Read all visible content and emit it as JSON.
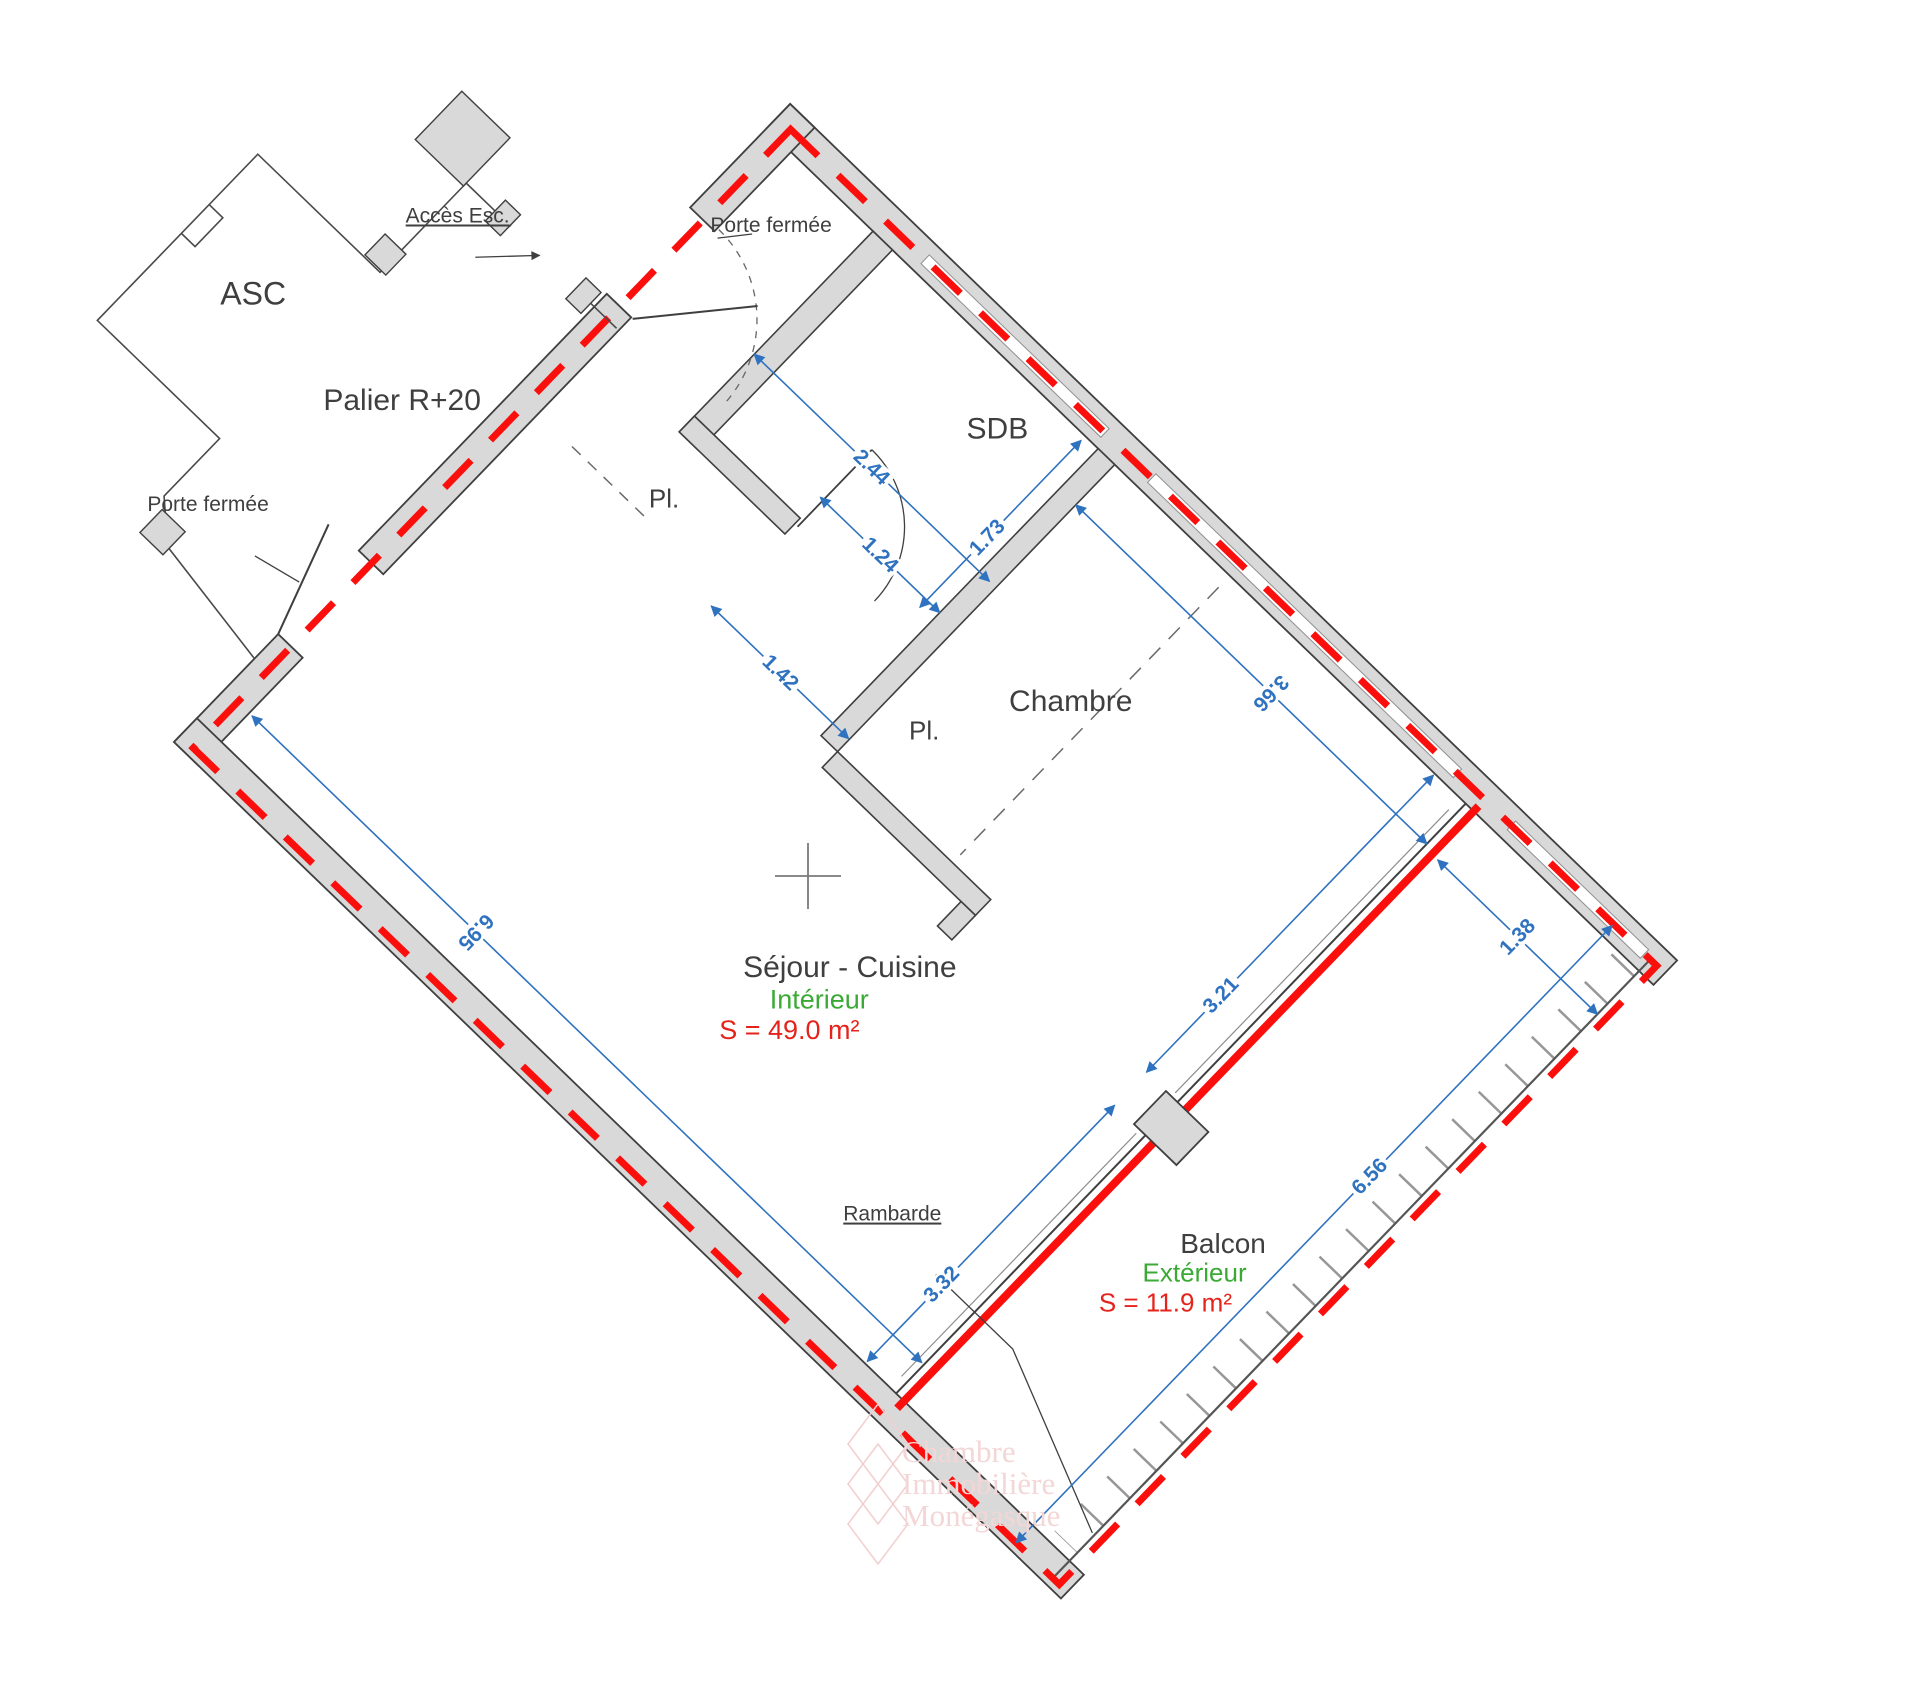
{
  "landing": {
    "asc": "ASC",
    "palier": "Palier R+20",
    "acces_esc": "Accès Esc.",
    "porte_fermee_top": "Porte fermée",
    "porte_fermee_left": "Porte fermée"
  },
  "rooms": {
    "sdb": "SDB",
    "pl_hall": "Pl.",
    "pl_chambre": "Pl.",
    "chambre": "Chambre",
    "sejour": "Séjour - Cuisine",
    "interieur": "Intérieur",
    "surface_interieur": "S = 49.0 m²",
    "balcon": "Balcon",
    "exterieur": "Extérieur",
    "surface_exterieur": "S = 11.9 m²",
    "rambarde": "Rambarde"
  },
  "dimensions": {
    "sdb_width": "2.44",
    "sdb_door": "1.24",
    "hall_width": "1.42",
    "sdb_depth": "1.73",
    "chambre_width": "3.66",
    "sejour_length": "6.95",
    "facade_upper": "3.21",
    "facade_lower": "3.32",
    "balcon_width": "1.38",
    "balcon_length": "6.56"
  },
  "watermark": {
    "line1": "Chambre",
    "line2": "Immobilière",
    "line3": "Monégasque"
  },
  "colors": {
    "wall_fill": "#d9d9d9",
    "wall_outline": "#3f3f3f",
    "boundary_red": "#fb0f0c",
    "dimension_blue": "#2f72c0",
    "interior_green": "#3aaa35",
    "surface_red": "#e5231b"
  }
}
